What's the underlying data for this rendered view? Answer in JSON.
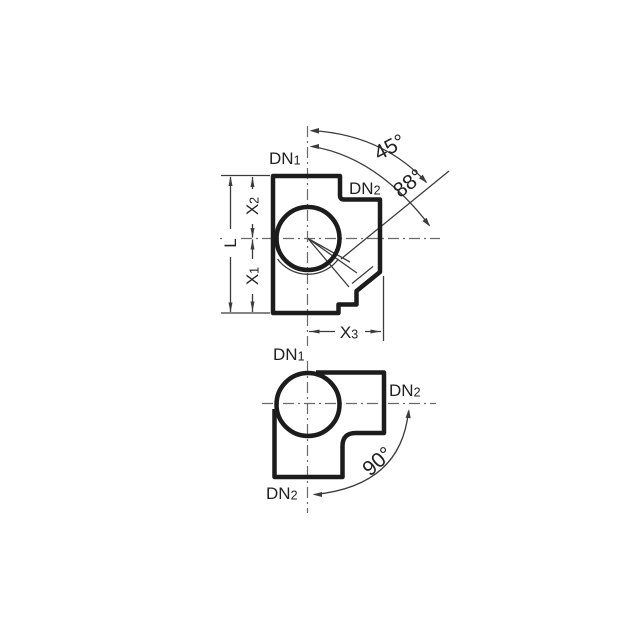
{
  "figure_top": {
    "port_dn1": {
      "prefix": "DN",
      "sub": "1"
    },
    "port_dn2": {
      "prefix": "DN",
      "sub": "2"
    },
    "angle_45": "45°",
    "angle_88": "88°",
    "dim_l": "L",
    "dim_x1": {
      "prefix": "X",
      "sub": "1"
    },
    "dim_x2": {
      "prefix": "X",
      "sub": "2"
    },
    "dim_x3": {
      "prefix": "X",
      "sub": "3"
    }
  },
  "figure_bottom": {
    "port_dn1": {
      "prefix": "DN",
      "sub": "1"
    },
    "port_dn2_right": {
      "prefix": "DN",
      "sub": "2"
    },
    "port_dn2_bottom": {
      "prefix": "DN",
      "sub": "2"
    },
    "angle_90": "90°"
  },
  "colors": {
    "ink": "#1c1c1c",
    "thin": "#3c3c3c",
    "centerline": "#6a6a6a",
    "text": "#222222",
    "bg": "#ffffff"
  }
}
